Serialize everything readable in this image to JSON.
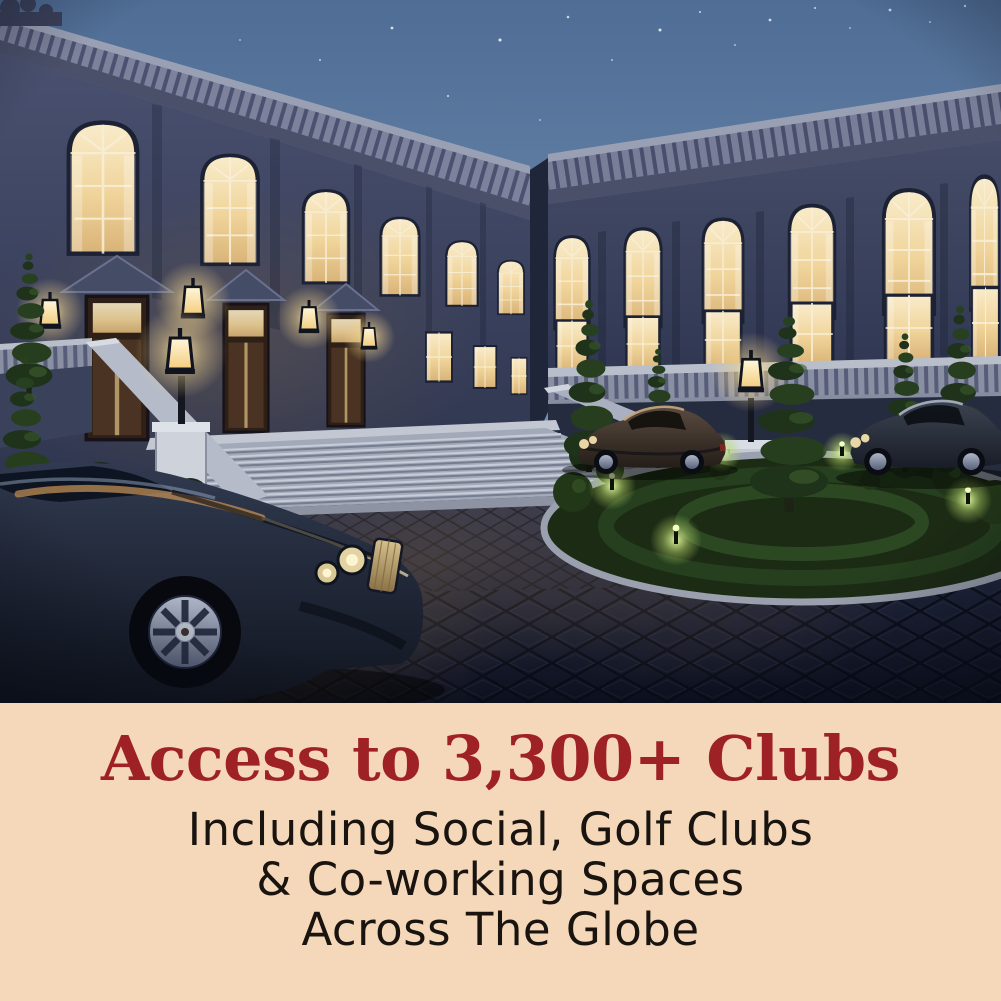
{
  "colors": {
    "band-bg": "#F5D8B9",
    "headline-red": "#9E2126",
    "body-text": "#1A1410"
  },
  "caption": {
    "headline": "Access to 3,300+ Clubs",
    "body_lines": [
      "Including Social, Golf Clubs",
      "& Co-working Spaces",
      "Across The Globe"
    ]
  },
  "scene": {
    "palette": {
      "sky-top": "#4F6D95",
      "sky-horizon": "#90A7C2",
      "stone-facade": "#3A4158",
      "balustrade": "#7C829B",
      "window-glow": "#F3DFAE",
      "foliage": "#22361C",
      "courtyard": "#161B2C",
      "car-body": "#1E2535"
    }
  }
}
